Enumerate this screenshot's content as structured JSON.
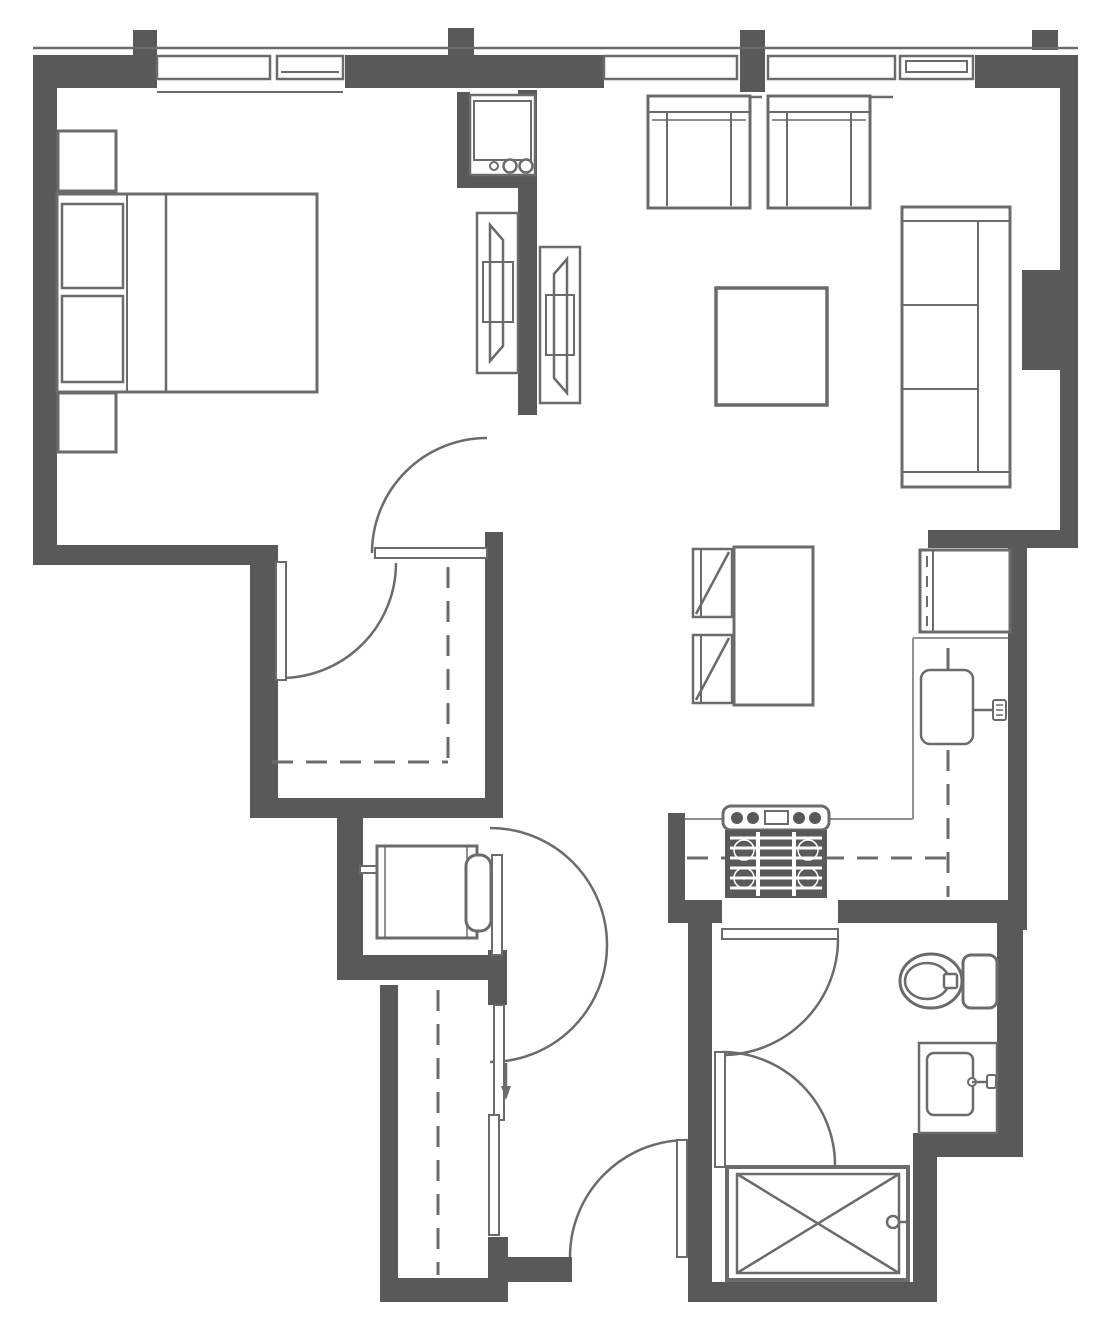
{
  "title": "one-bedroom-apartment-floor-plan",
  "colors": {
    "background": "#ffffff",
    "wall": "#595959",
    "line": "#6b6b6b",
    "thin": "#8f8f8f"
  },
  "plan": {
    "type": "architectural-floor-plan",
    "style": "grayscale line drawing, no text labels",
    "rooms": [
      "bedroom",
      "walk-in-closet",
      "living-room",
      "dining-area",
      "kitchen",
      "hallway",
      "utility-closet",
      "hall-closet",
      "bathroom",
      "entry"
    ],
    "window_count": 5,
    "door_swing_count": 6,
    "sliding_panel_count": 3,
    "fixtures": {
      "bedroom": [
        "double-bed",
        "pillow",
        "pillow",
        "nightstand",
        "nightstand",
        "wall-mounted-tv"
      ],
      "living_room": [
        "armchair",
        "armchair",
        "coffee-table",
        "three-seat-sofa",
        "wall-mounted-tv",
        "wall-niche"
      ],
      "dining_area": [
        "dining-table",
        "dining-chair",
        "dining-chair"
      ],
      "kitchen": [
        "refrigerator",
        "kitchen-sink",
        "faucet",
        "range-stove",
        "counter",
        "upper-cabinets-dashed"
      ],
      "utility": [
        "stacked-washer-dryer",
        "water-heater"
      ],
      "closets": [
        "closet-rod-dashed",
        "sliding-door-panels",
        "slide-direction-arrow"
      ],
      "bathroom": [
        "toilet",
        "vanity-sink",
        "shower-with-cross"
      ]
    }
  }
}
